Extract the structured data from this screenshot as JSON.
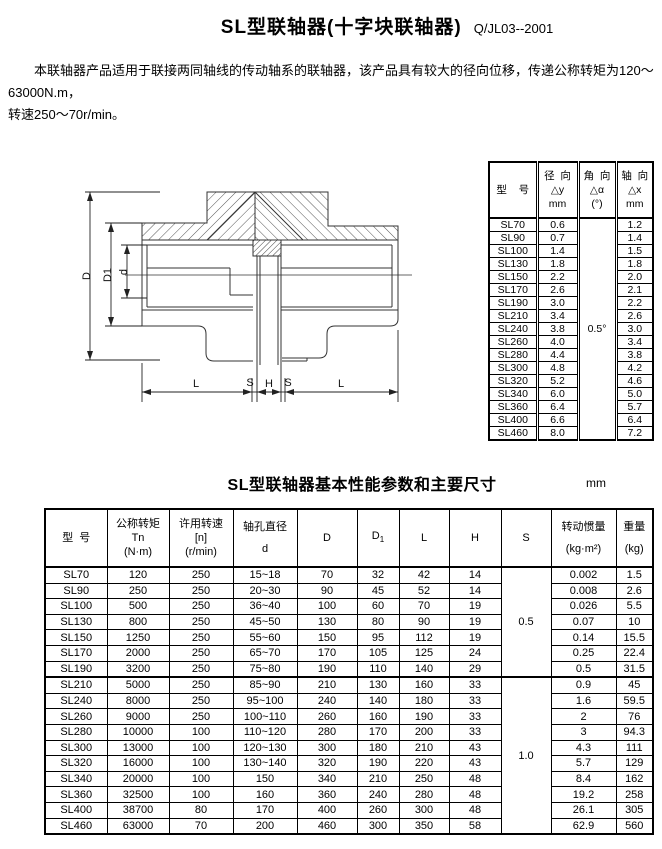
{
  "page": {
    "title": "SL型联轴器(十字块联轴器)",
    "doc_number": "Q/JL03--2001",
    "intro": [
      "本联轴器产品适用于联接两同轴线的传动轴系的联轴器，该产品具有较大的径向位移，传递公称转矩为120～63000N.m，",
      "转速250～70r/min。"
    ]
  },
  "drawing": {
    "labels": {
      "D": "D",
      "D1": "D1",
      "d": "d",
      "L": "L",
      "S": "S",
      "H": "H"
    }
  },
  "misalignment_table": {
    "headers": {
      "model": "型    号",
      "radial": {
        "title": "径  向",
        "symbol": "△y",
        "unit": "mm"
      },
      "angular": {
        "title": "角  向",
        "symbol": "△α",
        "unit": "(°)"
      },
      "axial": {
        "title": "轴  向",
        "symbol": "△x",
        "unit": "mm"
      }
    },
    "angular_value": "0.5°",
    "rows": [
      {
        "model": "SL70",
        "radial": "0.6",
        "axial": "1.2"
      },
      {
        "model": "SL90",
        "radial": "0.7",
        "axial": "1.4"
      },
      {
        "model": "SL100",
        "radial": "1.4",
        "axial": "1.5"
      },
      {
        "model": "SL130",
        "radial": "1.8",
        "axial": "1.8"
      },
      {
        "model": "SL150",
        "radial": "2.2",
        "axial": "2.0"
      },
      {
        "model": "SL170",
        "radial": "2.6",
        "axial": "2.1"
      },
      {
        "model": "SL190",
        "radial": "3.0",
        "axial": "2.2"
      },
      {
        "model": "SL210",
        "radial": "3.4",
        "axial": "2.6"
      },
      {
        "model": "SL240",
        "radial": "3.8",
        "axial": "3.0"
      },
      {
        "model": "SL260",
        "radial": "4.0",
        "axial": "3.4"
      },
      {
        "model": "SL280",
        "radial": "4.4",
        "axial": "3.8"
      },
      {
        "model": "SL300",
        "radial": "4.8",
        "axial": "4.2"
      },
      {
        "model": "SL320",
        "radial": "5.2",
        "axial": "4.6"
      },
      {
        "model": "SL340",
        "radial": "6.0",
        "axial": "5.0"
      },
      {
        "model": "SL360",
        "radial": "6.4",
        "axial": "5.7"
      },
      {
        "model": "SL400",
        "radial": "6.6",
        "axial": "6.4"
      },
      {
        "model": "SL460",
        "radial": "8.0",
        "axial": "7.2"
      }
    ]
  },
  "main_table": {
    "caption": "SL型联轴器基本性能参数和主要尺寸",
    "unit_note": "mm",
    "headers": {
      "model": "型  号",
      "torque": {
        "l1": "公称转矩",
        "l2": "Tn",
        "l3": "(N·m)"
      },
      "speed": {
        "l1": "许用转速",
        "l2": "[n]",
        "l3": "(r/min)"
      },
      "bore": {
        "l1": "轴孔直径",
        "l2": "d"
      },
      "D": "D",
      "D1": {
        "base": "D",
        "sub": "1"
      },
      "L": "L",
      "H": "H",
      "S": "S",
      "inertia": {
        "l1": "转动惯量",
        "l2": "(kg·m²)"
      },
      "weight": {
        "l1": "重量",
        "l2": "(kg)"
      }
    },
    "s_groups": [
      {
        "value": "0.5",
        "rows": 7
      },
      {
        "value": "1.0",
        "rows": 10
      }
    ],
    "rows": [
      [
        "SL70",
        "120",
        "250",
        "15~18",
        "70",
        "32",
        "42",
        "14",
        "0.002",
        "1.5"
      ],
      [
        "SL90",
        "250",
        "250",
        "20~30",
        "90",
        "45",
        "52",
        "14",
        "0.008",
        "2.6"
      ],
      [
        "SL100",
        "500",
        "250",
        "36~40",
        "100",
        "60",
        "70",
        "19",
        "0.026",
        "5.5"
      ],
      [
        "SL130",
        "800",
        "250",
        "45~50",
        "130",
        "80",
        "90",
        "19",
        "0.07",
        "10"
      ],
      [
        "SL150",
        "1250",
        "250",
        "55~60",
        "150",
        "95",
        "112",
        "19",
        "0.14",
        "15.5"
      ],
      [
        "SL170",
        "2000",
        "250",
        "65~70",
        "170",
        "105",
        "125",
        "24",
        "0.25",
        "22.4"
      ],
      [
        "SL190",
        "3200",
        "250",
        "75~80",
        "190",
        "110",
        "140",
        "29",
        "0.5",
        "31.5"
      ],
      [
        "SL210",
        "5000",
        "250",
        "85~90",
        "210",
        "130",
        "160",
        "33",
        "0.9",
        "45"
      ],
      [
        "SL240",
        "8000",
        "250",
        "95~100",
        "240",
        "140",
        "180",
        "33",
        "1.6",
        "59.5"
      ],
      [
        "SL260",
        "9000",
        "250",
        "100~110",
        "260",
        "160",
        "190",
        "33",
        "2",
        "76"
      ],
      [
        "SL280",
        "10000",
        "100",
        "110~120",
        "280",
        "170",
        "200",
        "33",
        "3",
        "94.3"
      ],
      [
        "SL300",
        "13000",
        "100",
        "120~130",
        "300",
        "180",
        "210",
        "43",
        "4.3",
        "111"
      ],
      [
        "SL320",
        "16000",
        "100",
        "130~140",
        "320",
        "190",
        "220",
        "43",
        "5.7",
        "129"
      ],
      [
        "SL340",
        "20000",
        "100",
        "150",
        "340",
        "210",
        "250",
        "48",
        "8.4",
        "162"
      ],
      [
        "SL360",
        "32500",
        "100",
        "160",
        "360",
        "240",
        "280",
        "48",
        "19.2",
        "258"
      ],
      [
        "SL400",
        "38700",
        "80",
        "170",
        "400",
        "260",
        "300",
        "48",
        "26.1",
        "305"
      ],
      [
        "SL460",
        "63000",
        "70",
        "200",
        "460",
        "300",
        "350",
        "58",
        "62.9",
        "560"
      ]
    ]
  }
}
